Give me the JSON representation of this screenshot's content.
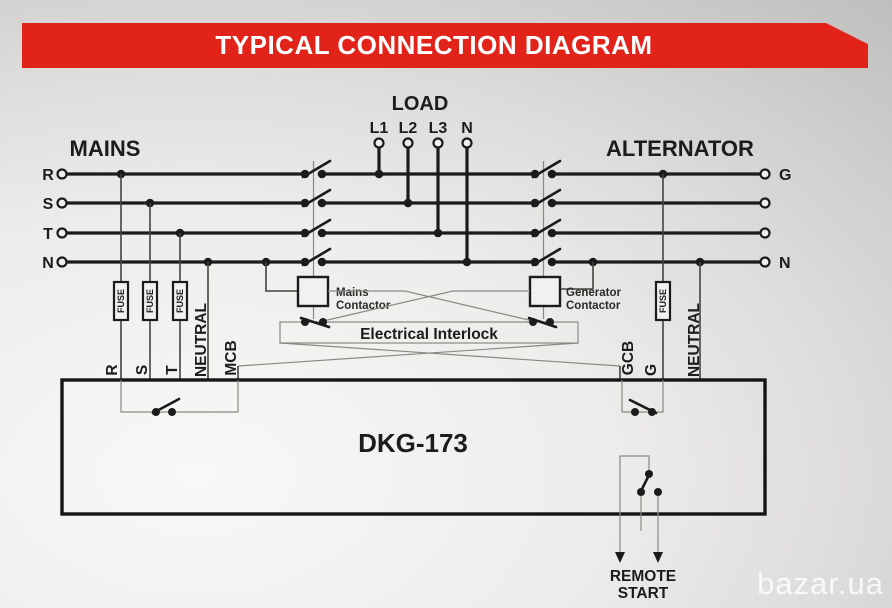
{
  "title": "TYPICAL CONNECTION DIAGRAM",
  "watermark": "bazar.ua",
  "labels": {
    "mains": "MAINS",
    "alternator": "ALTERNATOR",
    "load": "LOAD"
  },
  "load_terminals": [
    "L1",
    "L2",
    "L3",
    "N"
  ],
  "mains_phases": [
    "R",
    "S",
    "T",
    "N"
  ],
  "alternator_terminals": {
    "generator": "G",
    "neutral": "N"
  },
  "fuse": "FUSE",
  "contactors": {
    "mains": [
      "Mains",
      "Contactor"
    ],
    "generator": [
      "Generator",
      "Contactor"
    ]
  },
  "interlock": "Electrical Interlock",
  "controller": {
    "name": "DKG-173",
    "left_terminals": [
      "R",
      "S",
      "T",
      "NEUTRAL",
      "MCB"
    ],
    "right_terminals": [
      "GCB",
      "G",
      "NEUTRAL"
    ]
  },
  "remote_start": [
    "REMOTE",
    "START"
  ],
  "colors": {
    "banner_red": "#e2231a",
    "wire": "#1c1b19",
    "background_light": "#f9f8f6",
    "background_dark": "#bcbbb9"
  }
}
